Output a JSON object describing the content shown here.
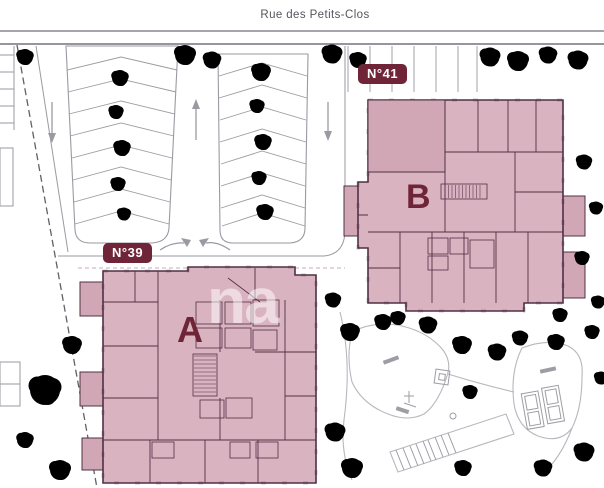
{
  "street": {
    "name": "Rue des Petits-Clos"
  },
  "buildings": [
    {
      "id": "A",
      "letter": "A",
      "address_label": "N°39"
    },
    {
      "id": "B",
      "letter": "B",
      "address_label": "N°41"
    }
  ],
  "watermark": {
    "text": "na"
  },
  "parking": {
    "lane_direction_icons": [
      "down-arrow-icon",
      "up-arrow-icon",
      "down-arrow-icon"
    ],
    "exit_arrow_icons": [
      "curve-arrow-right-icon",
      "curve-arrow-left-icon"
    ]
  },
  "icons": {
    "tree": "sketched-circle-cluster",
    "lane-arrow": "line-with-triangle-head",
    "stairs": "hatched-rectangle"
  },
  "colors": {
    "background": "#ffffff",
    "building_fill": "#d9b3c0",
    "building_fill_dark": "#d1a7b6",
    "wall_line": "#503043",
    "label_bg": "#6f2537",
    "label_text": "#ffffff",
    "letter": "#6f2537",
    "sketch": "#9a9aa2",
    "tree": "#a7a7b0",
    "street_line": "#87878f",
    "street_text": "#55565c",
    "boundary": "#606068"
  }
}
